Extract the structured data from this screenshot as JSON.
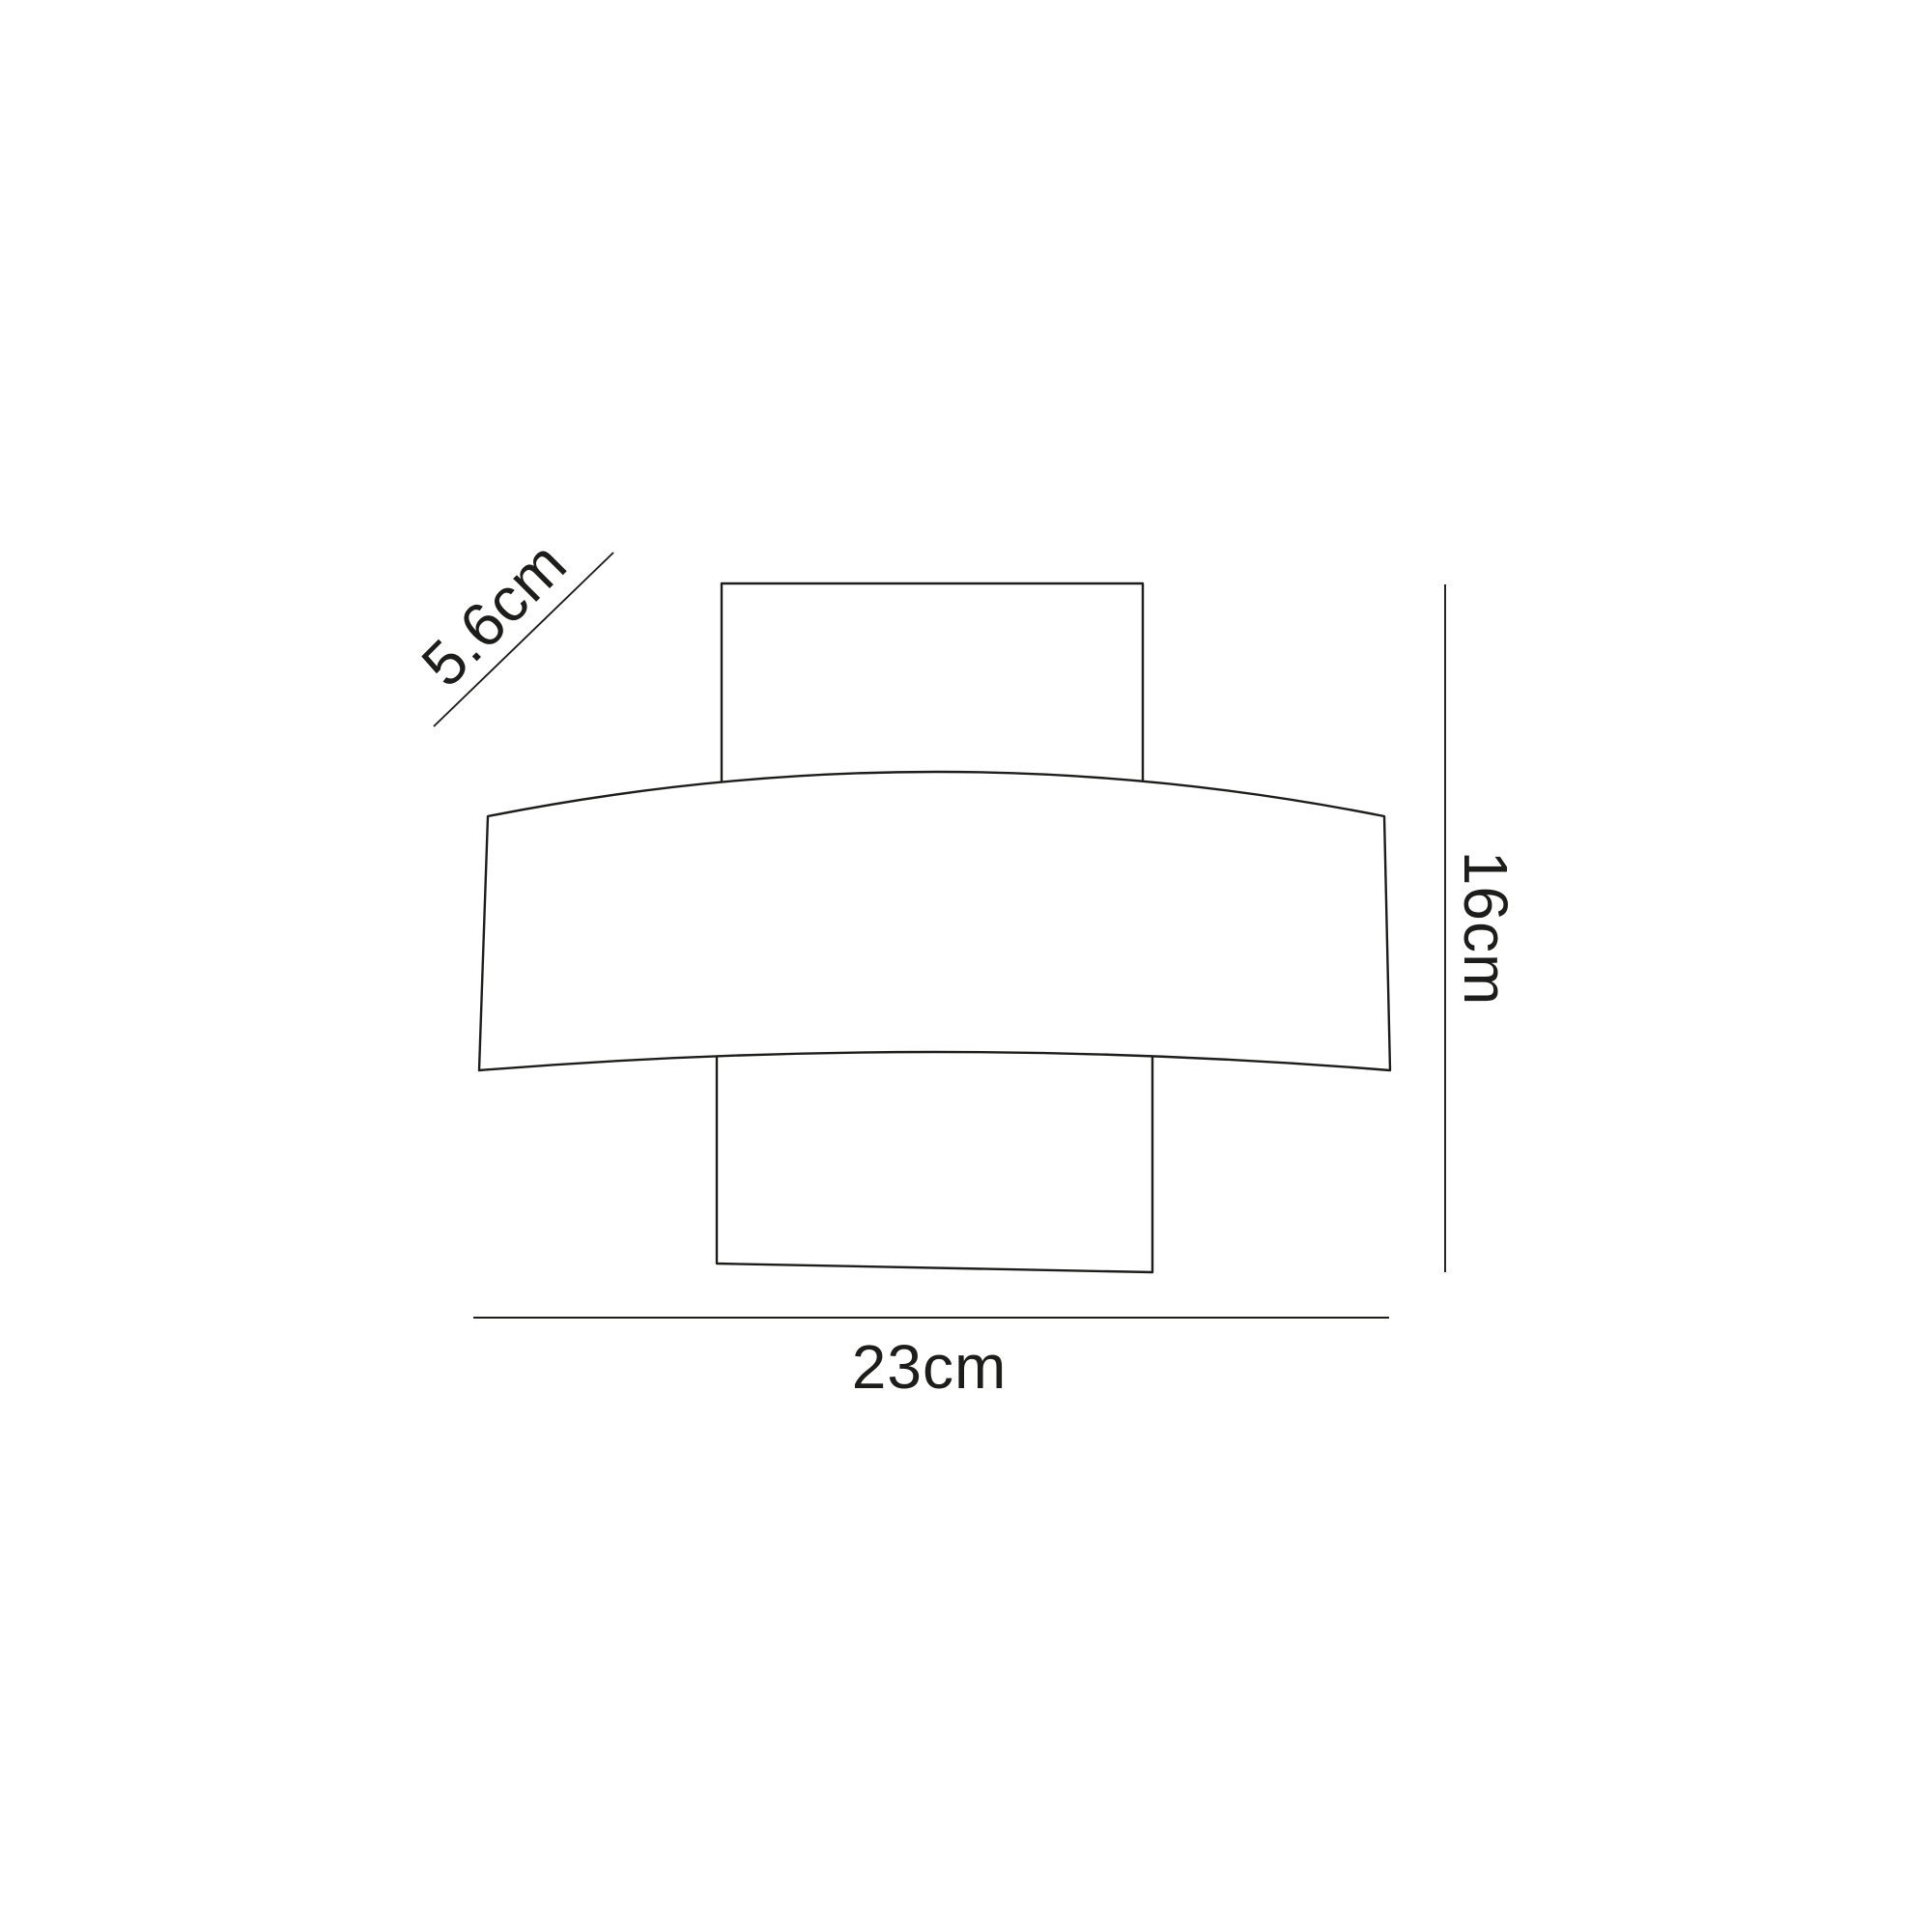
{
  "diagram": {
    "background_color": "#ffffff",
    "line_color": "#1d1d1b",
    "dimensions": {
      "depth": {
        "label": "5.6cm"
      },
      "height": {
        "label": "16cm"
      },
      "width": {
        "label": "23cm"
      }
    }
  }
}
